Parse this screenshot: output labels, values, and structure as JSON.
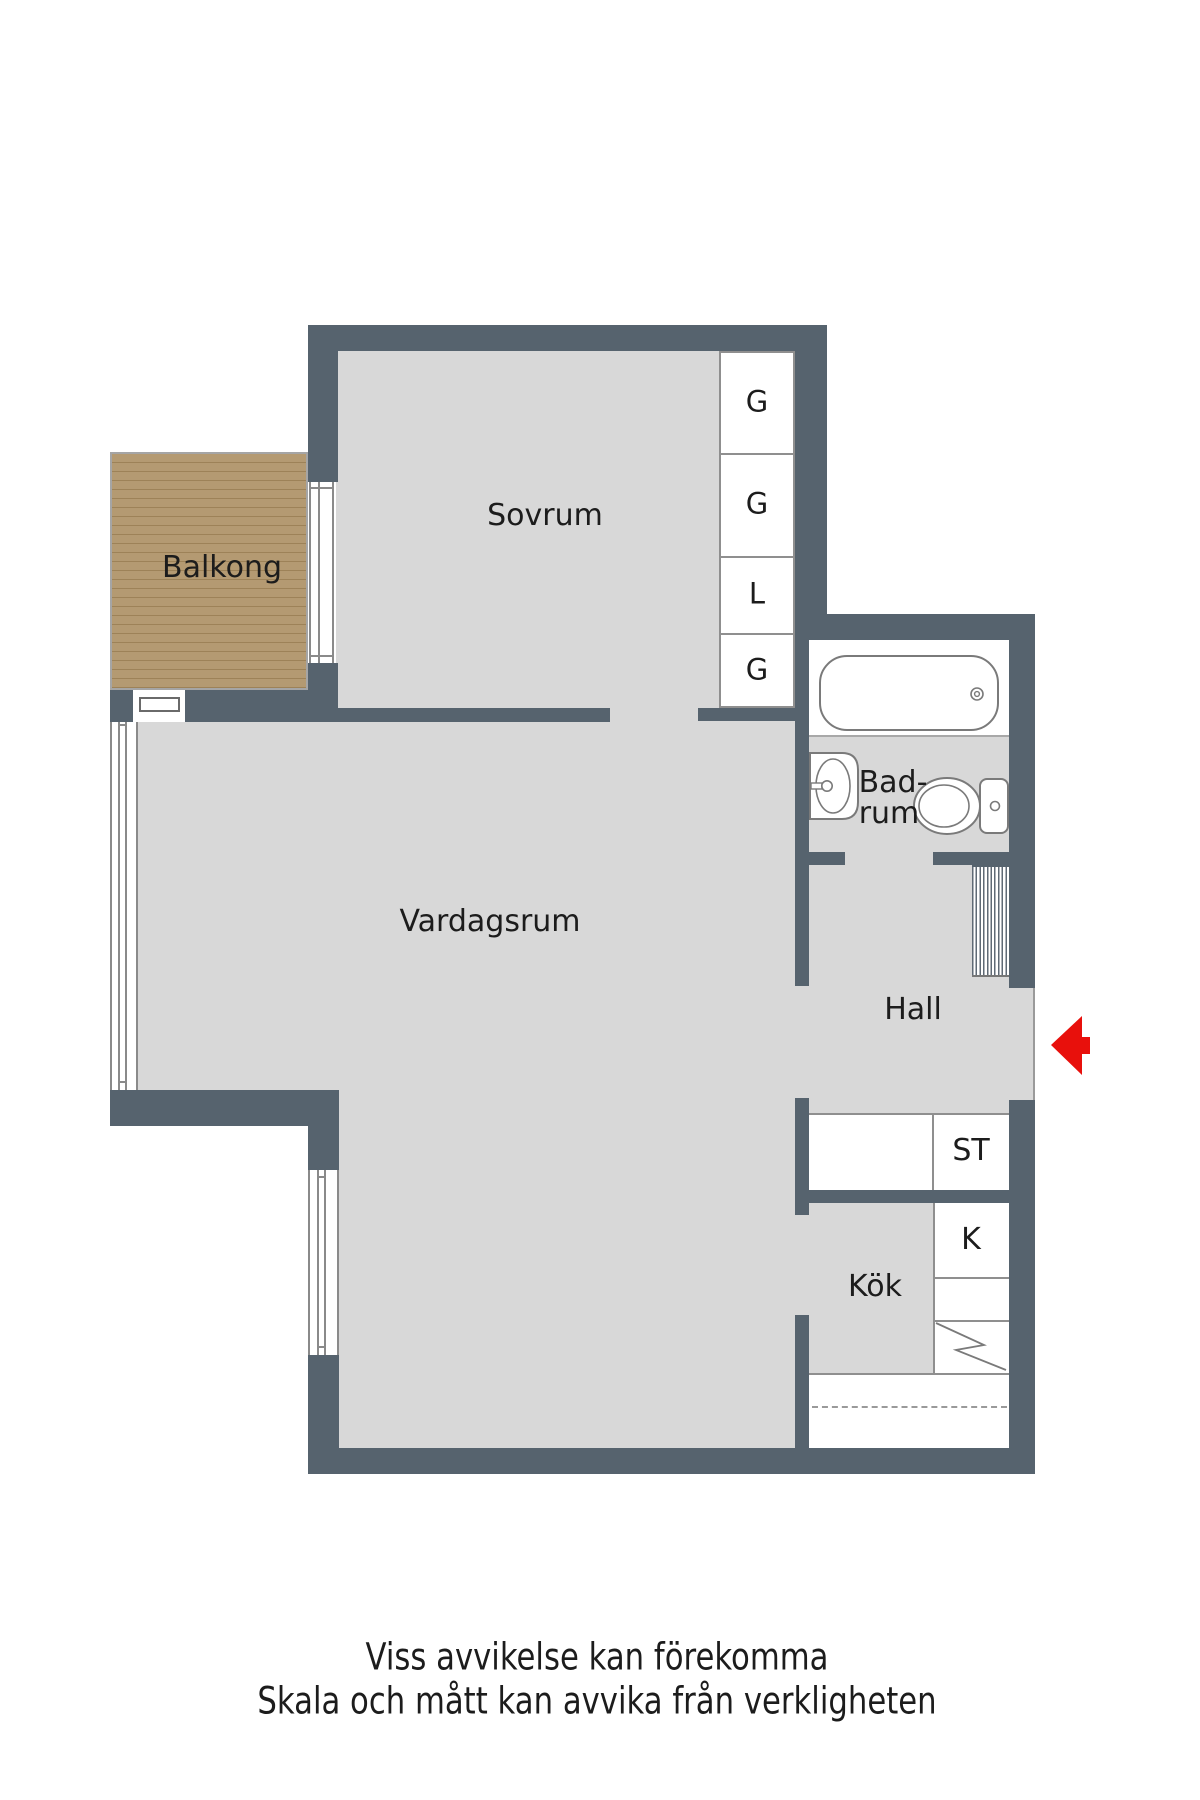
{
  "rooms": {
    "sovrum": "Sovrum",
    "balkong": "Balkong",
    "vardagsrum": "Vardagsrum",
    "badrum_line1": "Bad-",
    "badrum_line2": "rum",
    "hall": "Hall",
    "kok": "Kök"
  },
  "storage": {
    "g1": "G",
    "g2": "G",
    "l": "L",
    "g3": "G",
    "st": "ST",
    "k": "K"
  },
  "disclaimer": {
    "line1": "Viss avvikelse kan förekomma",
    "line2": "Skala och mått kan avvika från verkligheten"
  },
  "colors": {
    "wall": "#56636e",
    "floor": "#d8d8d8",
    "balcony_wood": "#b49a72",
    "balcony_wood_line": "#9d8258",
    "thin_outline": "#8f8f8f",
    "entrance_arrow": "#e8100c",
    "fixture_stroke": "#7a7a7a",
    "text": "#1c1c1c"
  }
}
